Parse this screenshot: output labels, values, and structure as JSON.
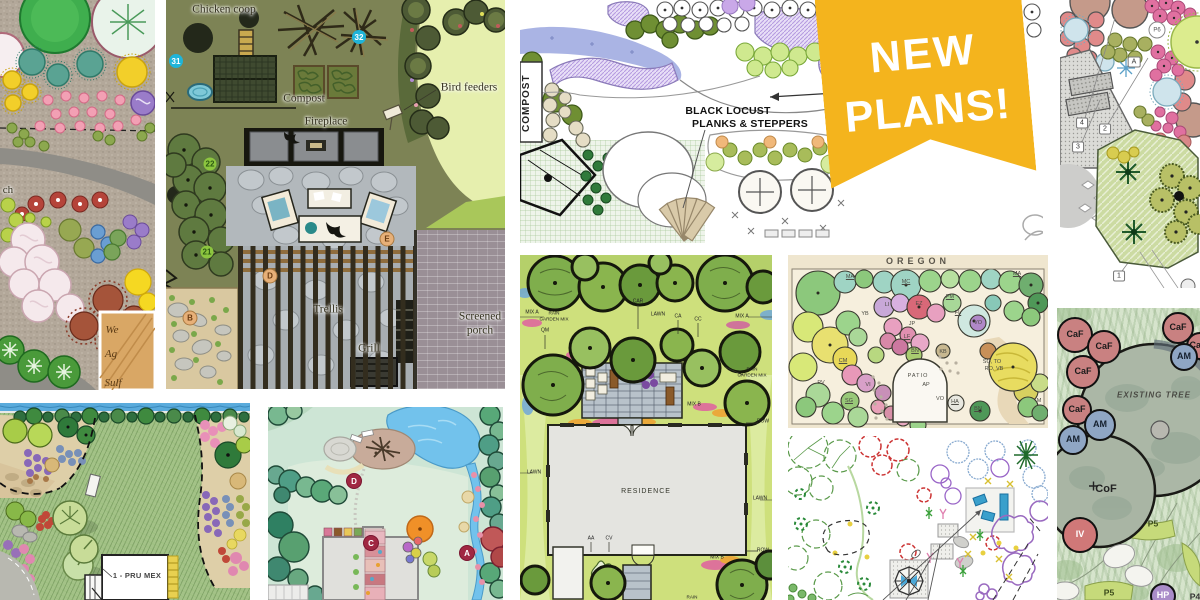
{
  "page": {
    "background": "#ffffff",
    "accent_gold": "#f4b41d"
  },
  "banner": {
    "line1": "NEW",
    "line2": "PLANS!",
    "color": "#f4b41d",
    "text_color": "#ffffff"
  },
  "tiles": {
    "perennial": {
      "edge_fragment": "ch",
      "legend_fragments": [
        "We",
        "Ag",
        "Sulf"
      ]
    },
    "coop": {
      "labels": {
        "chicken_coop": "Chicken coop",
        "compost": "Compost",
        "fireplace": "Fireplace",
        "bird_feeders": "Bird feeders",
        "trellis": "Trellis",
        "grill": "Grill",
        "screened_porch_1": "Screened",
        "screened_porch_2": "porch"
      },
      "markers": {
        "m31": "31",
        "m32": "32",
        "m22": "22",
        "m21": "21",
        "mB": "B",
        "mD": "D",
        "mE": "E"
      }
    },
    "locust": {
      "compost": "COMPOST",
      "label_line1": "BLACK LOCUST",
      "label_line2": "PLANKS & STEPPERS"
    },
    "right_garden": {
      "markers": {
        "p6": "P6",
        "n4": "4",
        "n2": "2",
        "n3": "3",
        "n1": "1",
        "a": "A"
      }
    },
    "oregon": {
      "title": "OREGON",
      "labels": [
        "MA",
        "MC",
        "MA",
        "PM",
        "YB",
        "LI",
        "EZ",
        "FL",
        "JP",
        "VO",
        "LF",
        "BN",
        "PATIO",
        "AP",
        "CM",
        "PV",
        "VI",
        "SG",
        "VO",
        "HA",
        "KB",
        "SO, TO",
        "RO, VB",
        "BN",
        "M"
      ]
    },
    "residence": {
      "labels": [
        "MIX A",
        "RAIN",
        "GARDEN MIX",
        "QM",
        "CAR",
        "LAWN",
        "CA",
        "CC",
        "MIX A",
        "RAIN",
        "GARDEN MIX",
        "MIX B",
        "ROW",
        "LAWN",
        "LAWN",
        "RESIDENCE",
        "AA",
        "CV",
        "MIX B",
        "ROW",
        "RAIN"
      ]
    },
    "pond": {
      "markers": {
        "d": "D",
        "c": "C",
        "a": "A"
      }
    },
    "prumex": {
      "building_label": "1 - PRU MEX"
    },
    "existing": {
      "labels": [
        "CaF",
        "CaF",
        "CaF",
        "CaF",
        "CaF",
        "AM",
        "CaF",
        "AM",
        "AM",
        "EXISTING TREE",
        "CoF",
        "P5",
        "IV",
        "P5",
        "HP",
        "P4"
      ]
    }
  }
}
